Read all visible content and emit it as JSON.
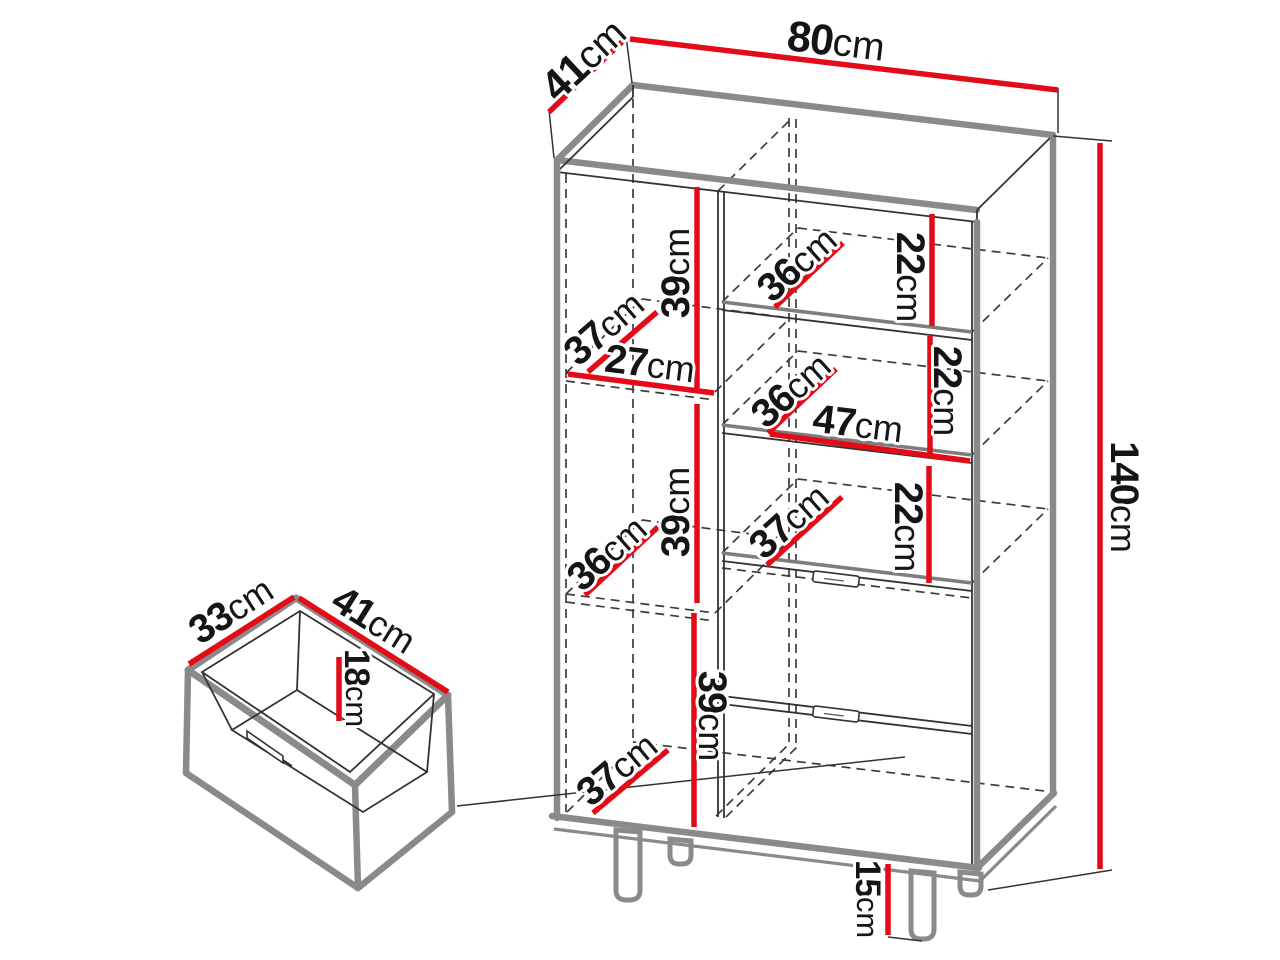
{
  "figure": {
    "type": "furniture-dimension-diagram",
    "units": "cm"
  },
  "palette": {
    "dimension_red": "#e30b17",
    "outline_gray": "#8a8a8a",
    "line_dark": "#333333",
    "text": "#151515",
    "background": "#ffffff"
  },
  "labels": {
    "depth_top": {
      "value": "41",
      "unit": "cm"
    },
    "width_top": {
      "value": "80",
      "unit": "cm"
    },
    "height_right": {
      "value": "140",
      "unit": "cm"
    },
    "left_gap_1": {
      "value": "39",
      "unit": "cm"
    },
    "left_shelf1_depth": {
      "value": "37",
      "unit": "cm"
    },
    "left_inner_width": {
      "value": "27",
      "unit": "cm"
    },
    "left_gap_2": {
      "value": "39",
      "unit": "cm"
    },
    "left_shelf2_depth": {
      "value": "36",
      "unit": "cm"
    },
    "left_gap_3": {
      "value": "39",
      "unit": "cm"
    },
    "left_bottom_depth": {
      "value": "37",
      "unit": "cm"
    },
    "right_shelf1_depth": {
      "value": "36",
      "unit": "cm"
    },
    "right_gap_1": {
      "value": "22",
      "unit": "cm"
    },
    "right_shelf2_depth": {
      "value": "36",
      "unit": "cm"
    },
    "right_inner_width": {
      "value": "47",
      "unit": "cm"
    },
    "right_gap_2": {
      "value": "22",
      "unit": "cm"
    },
    "right_shelf3_depth": {
      "value": "37",
      "unit": "cm"
    },
    "right_gap_3": {
      "value": "22",
      "unit": "cm"
    },
    "leg_height": {
      "value": "15",
      "unit": "cm"
    },
    "drawer_width": {
      "value": "33",
      "unit": "cm"
    },
    "drawer_depth": {
      "value": "41",
      "unit": "cm"
    },
    "drawer_height": {
      "value": "18",
      "unit": "cm"
    }
  }
}
